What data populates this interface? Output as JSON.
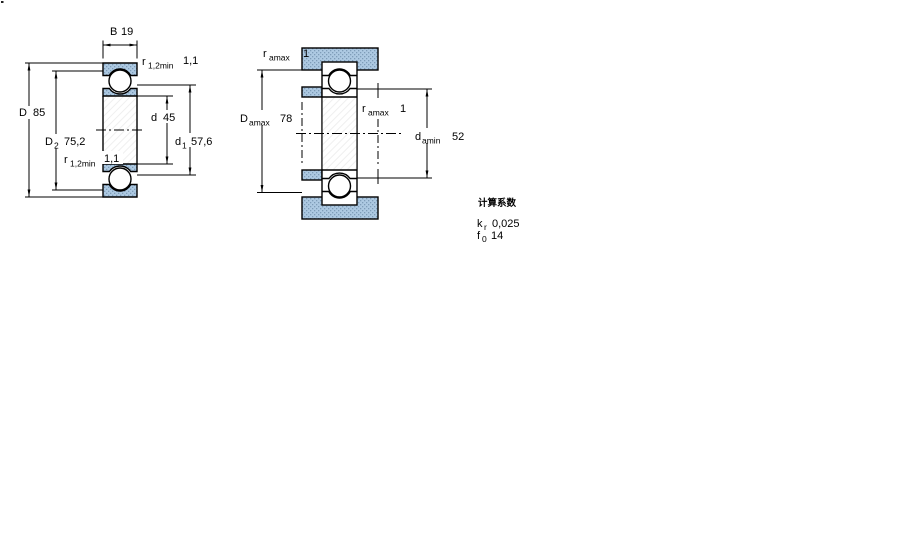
{
  "left": {
    "width": {
      "base": "B",
      "value": "19"
    },
    "r_top": {
      "base": "r",
      "sub": "1,2min",
      "value": "1,1"
    },
    "D": {
      "base": "D",
      "value": "85"
    },
    "D2": {
      "base": "D",
      "sub": "2",
      "value": "75,2"
    },
    "r_bot": {
      "base": "r",
      "sub": "1,2min",
      "value": "1,1"
    },
    "d": {
      "base": "d",
      "value": "45"
    },
    "d1": {
      "base": "d",
      "sub": "1",
      "value": "57,6"
    }
  },
  "right": {
    "r_top": {
      "base": "r",
      "sub": "amax",
      "value": "1"
    },
    "Da": {
      "base": "D",
      "sub": "amax",
      "value": "78"
    },
    "r_mid": {
      "base": "r",
      "sub": "amax",
      "value": "1"
    },
    "da": {
      "base": "d",
      "sub": "amin",
      "value": "52"
    }
  },
  "factors": {
    "title": "计算系数",
    "rows": [
      {
        "base": "k",
        "sub": "r",
        "value": "0,025"
      },
      {
        "base": "f",
        "sub": "0",
        "value": "14"
      }
    ]
  },
  "colors": {
    "section_fill": "#adc9e2",
    "section_dot": "#7e9cb8",
    "line": "#000000",
    "background": "#ffffff"
  }
}
